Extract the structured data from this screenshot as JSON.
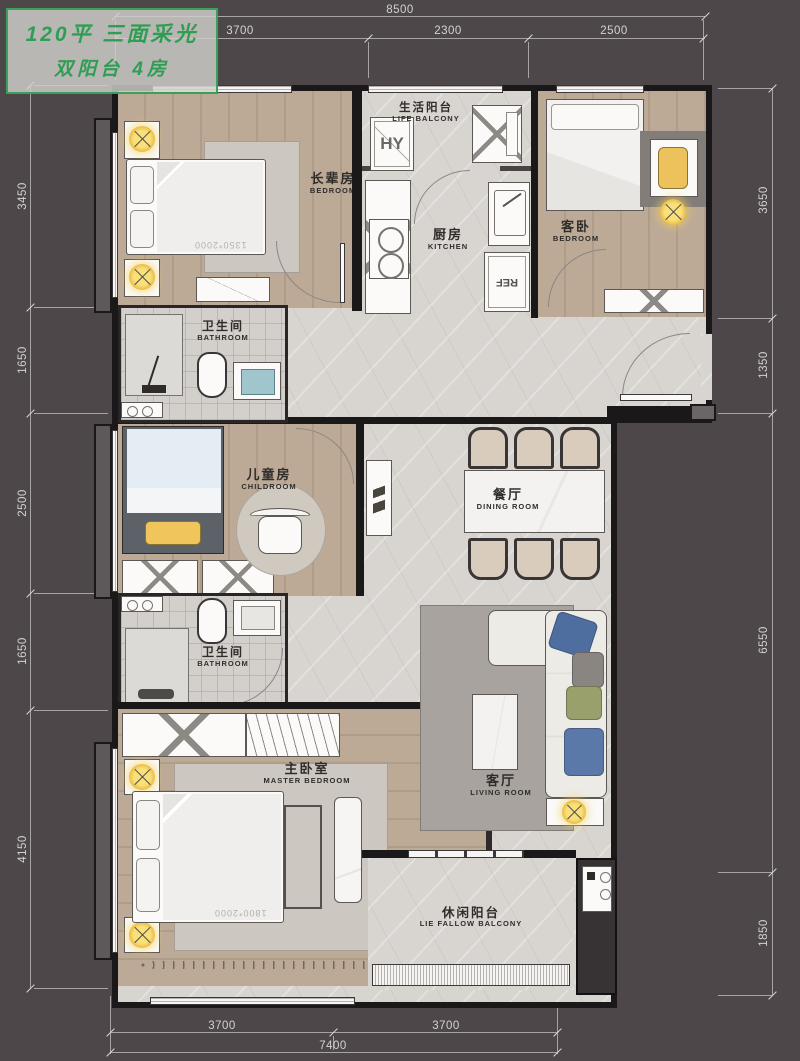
{
  "title": {
    "line1": "120平 三面采光",
    "line2": "双阳台 4房"
  },
  "rooms": {
    "elder": {
      "cn": "长辈房",
      "en": "BEDROOM"
    },
    "life_balcony": {
      "cn": "生活阳台",
      "en": "LIFE BALCONY"
    },
    "kitchen": {
      "cn": "厨房",
      "en": "KITCHEN"
    },
    "guest": {
      "cn": "客卧",
      "en": "BEDROOM"
    },
    "bathroom1": {
      "cn": "卫生间",
      "en": "BATHROOM"
    },
    "child": {
      "cn": "儿童房",
      "en": "CHILDROOM"
    },
    "dining": {
      "cn": "餐厅",
      "en": "DINING ROOM"
    },
    "bathroom2": {
      "cn": "卫生间",
      "en": "BATHROOM"
    },
    "master": {
      "cn": "主卧室",
      "en": "MASTER BEDROOM"
    },
    "living": {
      "cn": "客厅",
      "en": "LIVING ROOM"
    },
    "leisure_balcony": {
      "cn": "休闲阳台",
      "en": "LIE FALLOW BALCONY"
    }
  },
  "labels": {
    "elder_bed_size": "1350*2000",
    "master_bed_size": "1800*2000",
    "fridge": "REF",
    "washer": "HY"
  },
  "dimensions": {
    "top": {
      "total": "8500",
      "segments": [
        "3700",
        "2300",
        "2500"
      ]
    },
    "left": {
      "segments": [
        "3450",
        "1650",
        "2500",
        "1650",
        "4150"
      ]
    },
    "right": {
      "segments": [
        "3650",
        "1350",
        "6550",
        "1850"
      ]
    },
    "bottom": {
      "segments": [
        "3700",
        "3700"
      ],
      "total": "7400"
    }
  },
  "dim_marks": [
    {
      "text": "8500",
      "x": 400,
      "y": 10,
      "rot": 0
    },
    {
      "text": "3700",
      "x": 240,
      "y": 31,
      "rot": 0
    },
    {
      "text": "2300",
      "x": 448,
      "y": 31,
      "rot": 0
    },
    {
      "text": "2500",
      "x": 614,
      "y": 31,
      "rot": 0
    },
    {
      "text": "3450",
      "x": 23,
      "y": 196,
      "rot": -90
    },
    {
      "text": "1650",
      "x": 23,
      "y": 360,
      "rot": -90
    },
    {
      "text": "2500",
      "x": 23,
      "y": 503,
      "rot": -90
    },
    {
      "text": "1650",
      "x": 23,
      "y": 651,
      "rot": -90
    },
    {
      "text": "4150",
      "x": 23,
      "y": 849,
      "rot": -90
    },
    {
      "text": "3650",
      "x": 764,
      "y": 200,
      "rot": -90
    },
    {
      "text": "1350",
      "x": 764,
      "y": 365,
      "rot": -90
    },
    {
      "text": "6550",
      "x": 764,
      "y": 640,
      "rot": -90
    },
    {
      "text": "1850",
      "x": 764,
      "y": 933,
      "rot": -90
    },
    {
      "text": "3700",
      "x": 222,
      "y": 1026,
      "rot": 0
    },
    {
      "text": "3700",
      "x": 446,
      "y": 1026,
      "rot": 0
    },
    {
      "text": "7400",
      "x": 333,
      "y": 1046,
      "rot": 0
    }
  ],
  "dim_lines": [
    [
      115,
      16,
      590,
      1
    ],
    [
      115,
      38,
      590,
      1
    ],
    [
      30,
      85,
      1,
      903
    ],
    [
      772,
      88,
      1,
      907
    ],
    [
      110,
      1032,
      447,
      1
    ],
    [
      110,
      1052,
      447,
      1
    ],
    [
      115,
      20,
      1,
      60
    ],
    [
      368,
      42,
      1,
      36
    ],
    [
      528,
      42,
      1,
      36
    ],
    [
      703,
      20,
      1,
      60
    ],
    [
      34,
      85,
      74,
      1
    ],
    [
      34,
      307,
      74,
      1
    ],
    [
      34,
      413,
      74,
      1
    ],
    [
      34,
      593,
      74,
      1
    ],
    [
      34,
      710,
      74,
      1
    ],
    [
      34,
      988,
      74,
      1
    ],
    [
      718,
      88,
      54,
      1
    ],
    [
      718,
      318,
      54,
      1
    ],
    [
      718,
      413,
      54,
      1
    ],
    [
      718,
      872,
      54,
      1
    ],
    [
      718,
      995,
      54,
      1
    ],
    [
      110,
      996,
      1,
      58
    ],
    [
      333,
      1036,
      1,
      14
    ],
    [
      557,
      996,
      1,
      58
    ]
  ],
  "dim_ticks": [
    [
      115,
      16
    ],
    [
      705,
      16
    ],
    [
      115,
      38
    ],
    [
      368,
      38
    ],
    [
      528,
      38
    ],
    [
      703,
      38
    ],
    [
      30,
      85
    ],
    [
      30,
      307
    ],
    [
      30,
      413
    ],
    [
      30,
      593
    ],
    [
      30,
      710
    ],
    [
      30,
      988
    ],
    [
      772,
      88
    ],
    [
      772,
      318
    ],
    [
      772,
      413
    ],
    [
      772,
      872
    ],
    [
      772,
      995
    ],
    [
      110,
      1032
    ],
    [
      333,
      1032
    ],
    [
      557,
      1032
    ],
    [
      110,
      1052
    ],
    [
      557,
      1052
    ]
  ],
  "colors": {
    "background": "#4d4749",
    "wall": "#1b1819",
    "wood_floor": "#b7a491",
    "marble_floor": "#d8d5d1",
    "accent_yellow": "#f0c85c",
    "accent_blue": "#5b79a8",
    "title_green": "#2f9e54",
    "dim_text": "#d4d1d2"
  }
}
